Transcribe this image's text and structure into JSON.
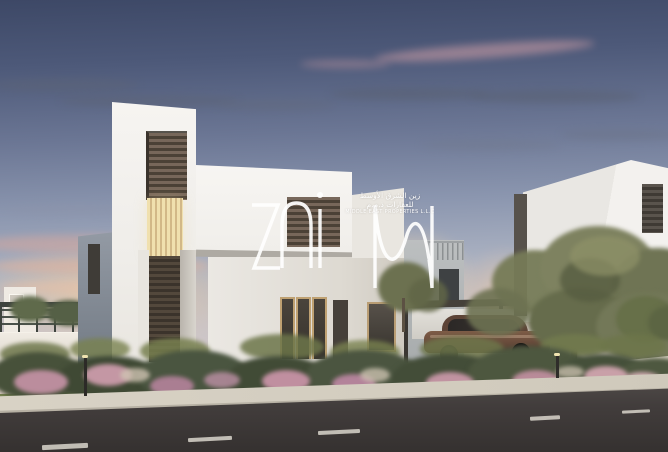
{
  "image": {
    "kind": "real-estate-listing-photo",
    "description": "Twilight architectural render of modern white two-storey villas with landscaped sidewalk, asphalt street in the foreground, a bronze car parked under a carport between the villas, trees and flowering bushes at dusk",
    "time_of_day": "dusk"
  },
  "watermark": {
    "brand": "ZAIN",
    "arabic_line_1": "زين الشرق الأوسط",
    "arabic_line_2": "للعقارات ذ.م.م",
    "english_line": "MIDDLE EAST PROPERTIES L.L.C",
    "text_color": "#ffffff"
  },
  "palette": {
    "sky_top": "#3d4866",
    "sky_mid": "#8b96af",
    "sky_horizon": "#e6d0bd",
    "sunset_glow": "#f0d2a8",
    "cloud_pink": "#d2a0a7",
    "cloud_dark": "#5a6173",
    "villa_white": "#f2f0ed",
    "villa_shadow_wall": "#7b838d",
    "louver_brown": "#6b5c4c",
    "lit_window": "#ecd9a8",
    "foliage_green": "#6e7452",
    "flower_pink": "#c08fa0",
    "road_asphalt": "#3c3838",
    "sidewalk": "#d5cfc2",
    "car_bronze": "#70503f"
  },
  "scene_objects": [
    "dusk-sky",
    "pink-clouds",
    "sunset-glow",
    "distant-house",
    "garden-pergola",
    "boundary-wall",
    "main-villa",
    "tower-louver-window",
    "lit-stair-window",
    "entrance-door",
    "wing-louver-window",
    "ground-floor-windows",
    "right-villa",
    "background-house",
    "roof-railing",
    "carport",
    "parked-car",
    "garage-door",
    "large-tree",
    "small-trees",
    "flower-bushes",
    "ornamental-grasses",
    "lawn",
    "entrance-walkway",
    "driveway",
    "sidewalk",
    "road",
    "lane-markings",
    "garden-light-bollards",
    "zain-watermark"
  ]
}
